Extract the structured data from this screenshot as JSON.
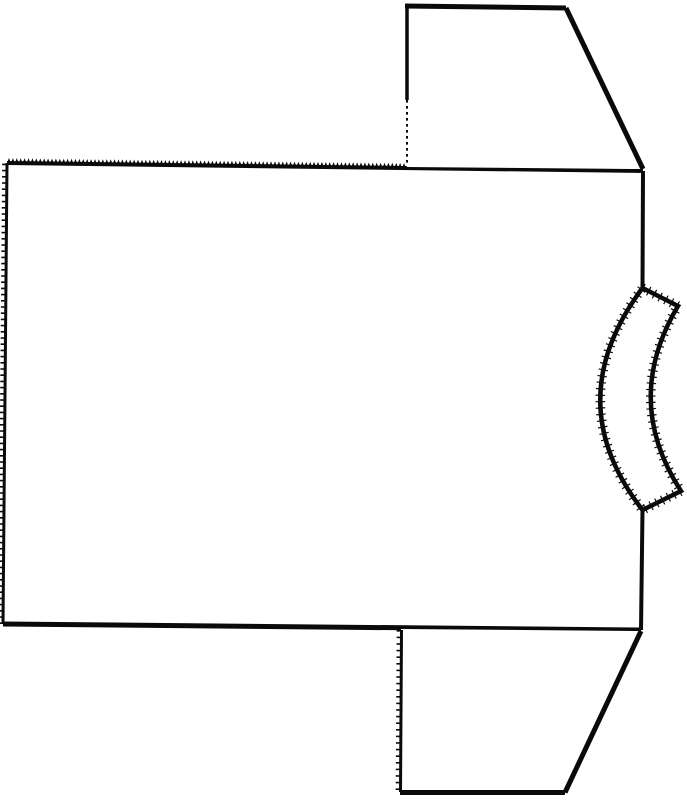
{
  "diagram": {
    "canvas": {
      "width": 687,
      "height": 800
    },
    "colors": {
      "paper": "#ffffff",
      "ink": "#0a0a0a"
    },
    "pieces": [
      {
        "id": "body-panel",
        "kind": "pattern-piece"
      },
      {
        "id": "top-sleeve",
        "kind": "pattern-piece"
      },
      {
        "id": "bottom-sleeve",
        "kind": "pattern-piece"
      },
      {
        "id": "neckband",
        "kind": "pattern-piece"
      }
    ],
    "fills": [
      {
        "group": "body-panel",
        "name": "body-panel-face",
        "d": [
          [
            "M",
            7,
            163
          ],
          [
            "L",
            643,
            171
          ],
          [
            "L",
            641,
            630
          ],
          [
            "L",
            3,
            624
          ],
          [
            "Z"
          ]
        ]
      },
      {
        "group": "top-sleeve",
        "name": "top-sleeve-face",
        "d": [
          [
            "M",
            407,
            5
          ],
          [
            "L",
            566,
            8
          ],
          [
            "L",
            643,
            169
          ],
          [
            "L",
            407,
            167
          ],
          [
            "Z"
          ]
        ]
      },
      {
        "group": "bottom-sleeve",
        "name": "bottom-sleeve-face",
        "d": [
          [
            "M",
            401,
            629
          ],
          [
            "L",
            641,
            631
          ],
          [
            "L",
            565,
            793
          ],
          [
            "L",
            400,
            793
          ],
          [
            "Z"
          ]
        ]
      },
      {
        "group": "neckband",
        "name": "neckband-face",
        "d": [
          [
            "M",
            642.5,
            288
          ],
          [
            "L",
            678,
            306
          ],
          [
            "Q",
            622,
            400,
            681,
            491
          ],
          [
            "L",
            642.5,
            510
          ],
          [
            "Q",
            558,
            401,
            642.5,
            288
          ],
          [
            "Z"
          ]
        ]
      }
    ],
    "strokes": [
      {
        "group": "body-panel",
        "name": "body-top-edge",
        "d": [
          [
            "M",
            7,
            163
          ],
          [
            "L",
            643,
            171
          ]
        ],
        "width": 4
      },
      {
        "group": "body-panel",
        "name": "body-right-edge-upper",
        "d": [
          [
            "M",
            643,
            171
          ],
          [
            "L",
            642.5,
            288
          ]
        ],
        "width": 4
      },
      {
        "group": "body-panel",
        "name": "body-right-edge-lower",
        "d": [
          [
            "M",
            642.5,
            510
          ],
          [
            "L",
            641,
            630
          ]
        ],
        "width": 4
      },
      {
        "group": "body-panel",
        "name": "body-bottom-edge",
        "d": [
          [
            "M",
            641,
            630
          ],
          [
            "L",
            3,
            624
          ]
        ],
        "width": 5
      },
      {
        "group": "body-panel",
        "name": "body-left-edge",
        "d": [
          [
            "M",
            3,
            624
          ],
          [
            "L",
            7,
            163
          ]
        ],
        "width": 3
      },
      {
        "group": "top-sleeve",
        "name": "top-sleeve-left-edge-solid",
        "d": [
          [
            "M",
            407,
            5
          ],
          [
            "L",
            407,
            100
          ]
        ],
        "width": 3.5
      },
      {
        "group": "top-sleeve",
        "name": "top-sleeve-left-edge-dotted",
        "d": [
          [
            "M",
            407,
            100
          ],
          [
            "L",
            407,
            166
          ]
        ],
        "width": 2,
        "dash": "2.6 3.4"
      },
      {
        "group": "top-sleeve",
        "name": "top-sleeve-top-edge",
        "d": [
          [
            "M",
            405,
            6
          ],
          [
            "L",
            566,
            8
          ]
        ],
        "width": 5
      },
      {
        "group": "top-sleeve",
        "name": "top-sleeve-underarm-diagonal",
        "d": [
          [
            "M",
            566,
            8
          ],
          [
            "L",
            643,
            169
          ]
        ],
        "width": 5
      },
      {
        "group": "bottom-sleeve",
        "name": "bottom-sleeve-left-edge",
        "d": [
          [
            "M",
            401.5,
            630
          ],
          [
            "L",
            400.5,
            792
          ]
        ],
        "width": 3
      },
      {
        "group": "bottom-sleeve",
        "name": "bottom-sleeve-bottom-edge",
        "d": [
          [
            "M",
            400,
            792.5
          ],
          [
            "L",
            565,
            792.5
          ]
        ],
        "width": 5
      },
      {
        "group": "bottom-sleeve",
        "name": "bottom-sleeve-underarm-diagonal",
        "d": [
          [
            "M",
            641,
            631
          ],
          [
            "L",
            565,
            792.5
          ]
        ],
        "width": 5
      },
      {
        "group": "neckband",
        "name": "neckband-outline",
        "d": [
          [
            "M",
            642.5,
            288
          ],
          [
            "L",
            678,
            306
          ],
          [
            "Q",
            622,
            400,
            681,
            491
          ],
          [
            "L",
            642.5,
            510
          ],
          [
            "Q",
            558,
            401,
            642.5,
            288
          ],
          [
            "Z"
          ]
        ],
        "width": 4.5
      },
      {
        "group": "neckband",
        "name": "neckband-raw-edge-fuzz",
        "d": [
          [
            "M",
            642.5,
            288
          ],
          [
            "L",
            678,
            306
          ],
          [
            "Q",
            622,
            400,
            681,
            491
          ],
          [
            "L",
            642.5,
            510
          ],
          [
            "Q",
            558,
            401,
            642.5,
            288
          ],
          [
            "Z"
          ]
        ],
        "width": 9.5,
        "dash": "1.2 5.2"
      }
    ],
    "pinked_edges": [
      {
        "group": "body-panel",
        "name": "body-top-pinked-edge",
        "from": [
          7,
          163
        ],
        "to": [
          406,
          168
        ],
        "tooth": 3.9,
        "height": 5
      }
    ],
    "tick_edges": [
      {
        "group": "body-panel",
        "name": "body-left-tick-texture",
        "from": [
          3,
          624
        ],
        "to": [
          7,
          163
        ],
        "offset": [
          -2.6,
          0
        ],
        "width": 4.5,
        "dash": "1.6 4.6"
      },
      {
        "group": "bottom-sleeve",
        "name": "bottom-sleeve-left-tick-texture",
        "from": [
          401.5,
          630
        ],
        "to": [
          400.5,
          792
        ],
        "offset": [
          -2.6,
          0
        ],
        "width": 4.5,
        "dash": "1.6 5"
      }
    ]
  }
}
